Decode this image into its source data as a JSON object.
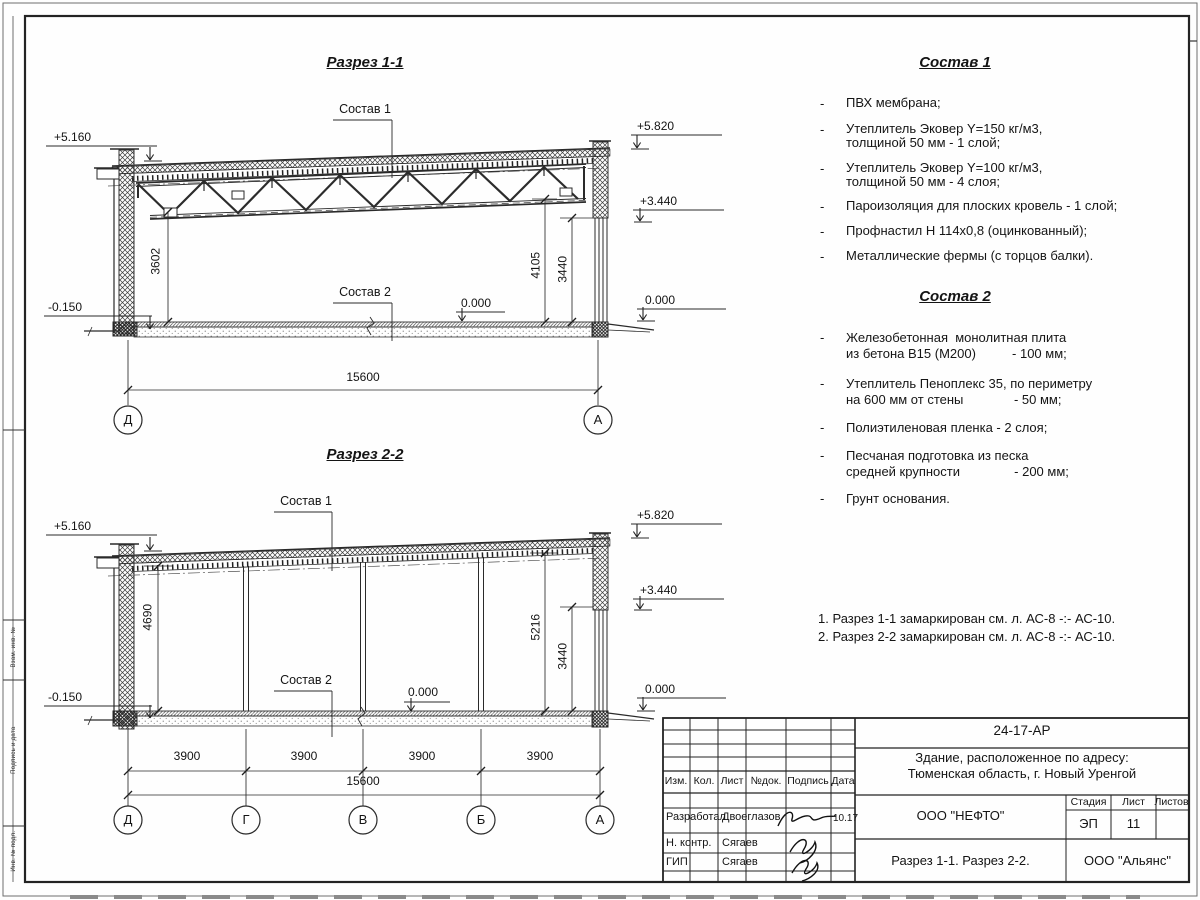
{
  "bullet": "-",
  "side_column": {
    "labels": [
      "Взам. инв. №",
      "Подпись и дата",
      "Инв. № подл."
    ]
  },
  "s1": {
    "title": "Разрез 1-1",
    "sostav1_label": "Состав 1",
    "sostav2_label": "Состав 2",
    "elev": {
      "left_top": "+5.160",
      "left_bot": "-0.150",
      "right_top": "+5.820",
      "right_mid": "+3.440",
      "right_zero": "0.000",
      "floor_zero": "0.000"
    },
    "dims": {
      "left": "3602",
      "right_a": "4105",
      "right_b": "3440",
      "total": "15600"
    },
    "axes": [
      "Д",
      "А"
    ]
  },
  "s2": {
    "title": "Разрез 2-2",
    "sostav1_label": "Состав 1",
    "sostav2_label": "Состав 2",
    "elev": {
      "left_top": "+5.160",
      "left_bot": "-0.150",
      "right_top": "+5.820",
      "right_mid": "+3.440",
      "right_zero": "0.000",
      "floor_zero": "0.000"
    },
    "dims": {
      "left": "4690",
      "right_a": "5216",
      "right_b": "3440",
      "total": "15600",
      "spans": [
        "3900",
        "3900",
        "3900",
        "3900"
      ]
    },
    "axes": [
      "Д",
      "Г",
      "В",
      "Б",
      "А"
    ]
  },
  "sostav1": {
    "title": "Состав 1",
    "items": [
      [
        "ПВХ мембрана;"
      ],
      [
        "Утеплитель Эковер Y=150 кг/м3,",
        "толщиной 50 мм - 1 слой;"
      ],
      [
        "Утеплитель Эковер Y=100 кг/м3,",
        "толщиной 50 мм - 4 слоя;"
      ],
      [
        "Пароизоляция для плоских кровель - 1 слой;"
      ],
      [
        "Профнастил Н 114х0,8 (оцинкованный);"
      ],
      [
        "Металлические фермы (с торцов балки)."
      ]
    ]
  },
  "sostav2": {
    "title": "Состав 2",
    "items": [
      [
        "Железобетонная  монолитная плита",
        "из бетона В15 (М200)          - 100 мм;"
      ],
      [
        "Утеплитель Пеноплекс 35, по периметру",
        "на 600 мм от стены              - 50 мм;"
      ],
      [
        "Полиэтиленовая пленка - 2 слоя;"
      ],
      [
        "Песчаная подготовка из песка",
        "средней крупности               - 200 мм;"
      ],
      [
        "Грунт основания."
      ]
    ]
  },
  "notes": [
    "1. Разрез 1-1 замаркирован см. л. АС-8 -:- АС-10.",
    "2. Разрез 2-2 замаркирован см. л. АС-8 -:- АС-10."
  ],
  "tb": {
    "doc_number": "24-17-АР",
    "object_line1": "Здание, расположенное по адресу:",
    "object_line2": "Тюменская область, г. Новый Уренгой",
    "cols": [
      "Изм.",
      "Кол.",
      "Лист",
      "№док.",
      "Подпись",
      "Дата"
    ],
    "rows": [
      {
        "role": "Разработал",
        "name": "Двоеглазов",
        "date": "10.17"
      },
      {
        "role": "Н. контр.",
        "name": "Сягаев",
        "date": ""
      },
      {
        "role": "ГИП",
        "name": "Сягаев",
        "date": ""
      }
    ],
    "company": "ООО \"НЕФТО\"",
    "stage_label": "Стадия",
    "sheet_label": "Лист",
    "sheets_label": "Листов",
    "stage": "ЭП",
    "sheet": "11",
    "sheets": "",
    "sheet_title": "Разрез 1-1. Разрез 2-2.",
    "org": "ООО \"Альянс\""
  }
}
